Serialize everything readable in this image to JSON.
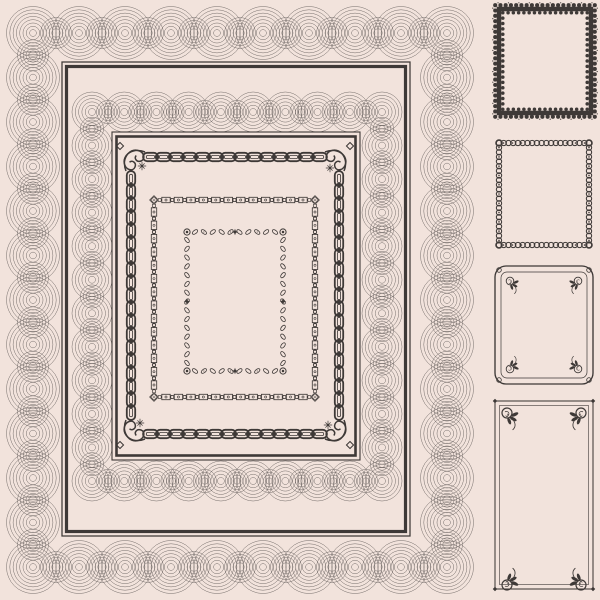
{
  "artwork": {
    "kind": "vintage-certificate-border-design-set",
    "visible_text": []
  },
  "palette": {
    "background": "#f2e3dc",
    "line_ink": "#57514f",
    "dark_ink": "#3e3937"
  },
  "main_certificate": {
    "name": "blank-certificate-template",
    "borders": [
      {
        "name": "outer-guilloche-lace-band",
        "edge": "scalloped"
      },
      {
        "name": "outer-double-line-frame"
      },
      {
        "name": "inner-guilloche-swag-band",
        "edge": "scalloped"
      },
      {
        "name": "inner-double-line-frame"
      },
      {
        "name": "chain-link-border",
        "corners": "scroll-flourish-with-diamond"
      },
      {
        "name": "ornate-cartouche-border",
        "corners": "diamond-and-ring"
      },
      {
        "name": "leaf-scroll-border",
        "corners": "ring-rosette",
        "side_marks": "four-point-star"
      }
    ]
  },
  "thumbnails": [
    {
      "id": "frame-1",
      "style": "scalloped-lace-heavy-border"
    },
    {
      "id": "frame-2",
      "style": "floral-bead-chain-border"
    },
    {
      "id": "frame-3",
      "style": "rounded-double-line-rose-corners"
    },
    {
      "id": "frame-4",
      "style": "square-double-line-rose-corners",
      "note": "cropped-at-page-edge"
    }
  ]
}
